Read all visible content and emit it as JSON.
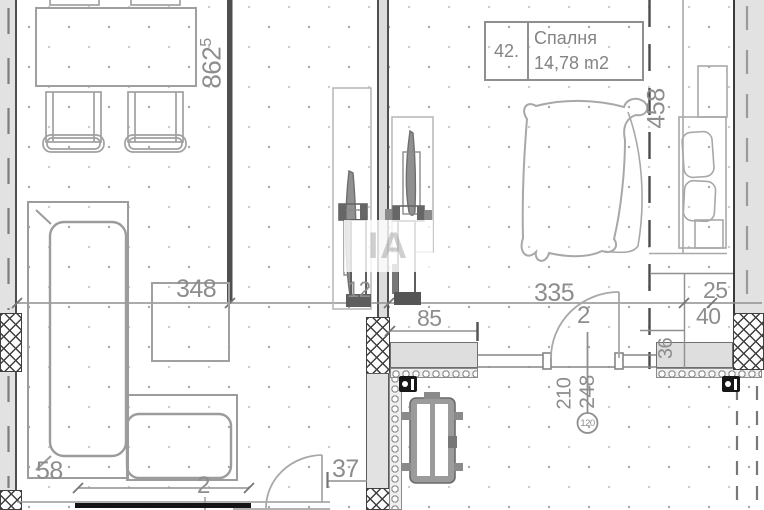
{
  "room_label": {
    "number": "42.",
    "name": "Спалня",
    "area": "14,78 m2"
  },
  "dims": {
    "total_height": {
      "main": "862",
      "sup": "5"
    },
    "living_width": "348",
    "bedroom_width": "335",
    "bedroom_depth": "458",
    "seg_25": "25",
    "seg_40": "40",
    "seg_36": "36",
    "seg_85": "85",
    "seg_58": "58",
    "seg_37": "37",
    "seg_12": "12",
    "door_living_label": "2",
    "door_bedroom_label": "2",
    "door_height": "210",
    "door_height2": "248",
    "door_width_circled": "120"
  },
  "watermark": "IA",
  "colors": {
    "line": "#9c9c9c",
    "wall_dark": "#4f4f4f",
    "wall_fill": "#e2e2e2",
    "hatch": "#3f3f3f",
    "dim_text": "#8d8d8d",
    "section_cut": "#141414"
  }
}
